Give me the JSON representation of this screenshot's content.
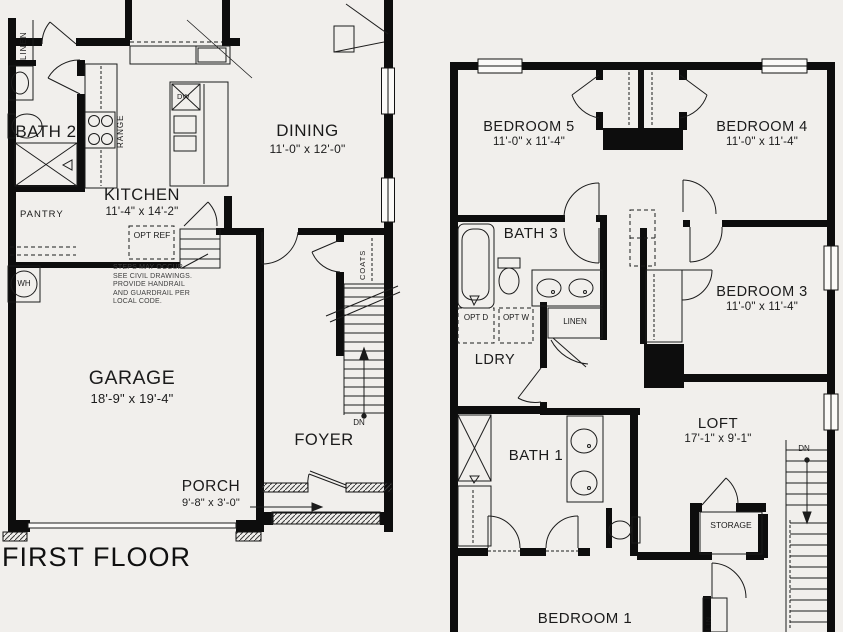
{
  "first_floor": {
    "title": "FIRST FLOOR",
    "rooms": {
      "dining": {
        "name": "DINING",
        "dims": "11'-0\" x 12'-0\""
      },
      "kitchen": {
        "name": "KITCHEN",
        "dims": "11'-4\" x 14'-2\""
      },
      "garage": {
        "name": "GARAGE",
        "dims": "18'-9\" x 19'-4\""
      },
      "porch": {
        "name": "PORCH",
        "dims": "9'-8\" x 3'-0\""
      },
      "foyer": {
        "name": "FOYER"
      },
      "bath2": {
        "name": "BATH 2"
      },
      "pantry": {
        "name": "PANTRY"
      },
      "linen": {
        "name": "LINEN"
      },
      "coats": {
        "name": "COATS"
      }
    },
    "fixtures": {
      "range": "RANGE",
      "dishwasher": "DW",
      "opt_fridge": "OPT REF",
      "water_heater": "WH",
      "stairs_down": "DN"
    },
    "note": [
      "STEPS MAY OCCUR.",
      "SEE CIVIL DRAWINGS.",
      "PROVIDE HANDRAIL",
      "AND GUARDRAIL PER",
      "LOCAL CODE."
    ]
  },
  "second_floor": {
    "rooms": {
      "bedroom5": {
        "name": "BEDROOM 5",
        "dims": "11'-0\" x 11'-4\""
      },
      "bedroom4": {
        "name": "BEDROOM 4",
        "dims": "11'-0\" x 11'-4\""
      },
      "bedroom3": {
        "name": "BEDROOM 3",
        "dims": "11'-0\" x 11'-4\""
      },
      "bedroom1": {
        "name": "BEDROOM 1"
      },
      "loft": {
        "name": "LOFT",
        "dims": "17'-1\" x 9'-1\""
      },
      "bath3": {
        "name": "BATH 3"
      },
      "bath1": {
        "name": "BATH 1"
      },
      "laundry": {
        "name": "LDRY"
      },
      "storage": {
        "name": "STORAGE"
      },
      "linen": {
        "name": "LINEN"
      },
      "linen_small": {
        "name": "LIN."
      }
    },
    "fixtures": {
      "opt_dryer": "OPT D",
      "opt_washer": "OPT W",
      "stairs_down": "DN"
    }
  },
  "colors": {
    "background": "#f1efec",
    "wall": "#0d0d0d",
    "line": "#1c1c1c",
    "note_text": "#3e3e3e"
  }
}
